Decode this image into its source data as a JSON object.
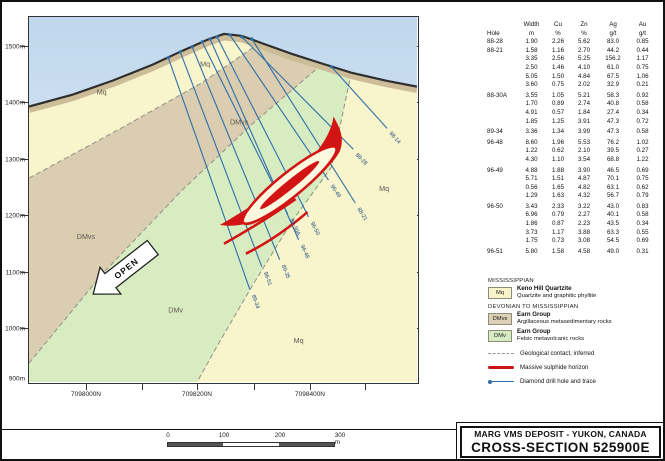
{
  "section": {
    "south": "SOUTH",
    "north": "NORTH",
    "elevations": [
      "1500m",
      "1400m",
      "1300m",
      "1200m",
      "1100m",
      "1000m",
      "900m"
    ],
    "northings": [
      "7098000N",
      "7098200N",
      "7098400N"
    ],
    "units": {
      "mq": "Mq",
      "dmvs": "DMvs",
      "dmv": "DMv"
    },
    "open_label": "OPEN",
    "drillholes": [
      "88-14",
      "88-28",
      "96-49",
      "88-21",
      "96-50",
      "88-30A",
      "96-48",
      "89-35",
      "96-51",
      "89-34"
    ]
  },
  "assay_table": {
    "headers": [
      "Hole",
      "Width",
      "Cu",
      "Zn",
      "Ag",
      "Au"
    ],
    "units": [
      "",
      "m",
      "%",
      "%",
      "g/t",
      "g/t"
    ],
    "rows": [
      [
        "88-28",
        "1.90",
        "2.26",
        "5.62",
        "83.0",
        "0.85"
      ],
      [
        "88-21",
        "1.58",
        "1.16",
        "2.70",
        "44.2",
        "0.44"
      ],
      [
        "",
        "3.35",
        "2.56",
        "5.25",
        "156.2",
        "1.17"
      ],
      [
        "",
        "2.50",
        "1.46",
        "4.10",
        "61.0",
        "0.75"
      ],
      [
        "",
        "5.05",
        "1.50",
        "4.84",
        "67.5",
        "1.06"
      ],
      [
        "",
        "3.60",
        "0.75",
        "2.02",
        "32.9",
        "0.21"
      ],
      [
        "88-30A",
        "3.55",
        "1.05",
        "5.21",
        "58.3",
        "0.92"
      ],
      [
        "",
        "1.70",
        "0.89",
        "2.74",
        "40.8",
        "0.58"
      ],
      [
        "",
        "4.91",
        "0.57",
        "1.84",
        "27.4",
        "0.34"
      ],
      [
        "",
        "1.85",
        "1.25",
        "3.91",
        "47.3",
        "0.72"
      ],
      [
        "89-34",
        "3.36",
        "1.34",
        "3.99",
        "47.3",
        "0.58"
      ],
      [
        "96-48",
        "8.60",
        "1.96",
        "5.53",
        "76.2",
        "1.02"
      ],
      [
        "",
        "1.22",
        "0.62",
        "2.10",
        "39.5",
        "0.27"
      ],
      [
        "",
        "4.30",
        "1.10",
        "3.54",
        "68.8",
        "1.22"
      ],
      [
        "96-49",
        "4.88",
        "1.88",
        "3.90",
        "46.5",
        "0.69"
      ],
      [
        "",
        "5.71",
        "1.51",
        "4.87",
        "70.1",
        "0.75"
      ],
      [
        "",
        "0.56",
        "1.65",
        "4.82",
        "63.1",
        "0.62"
      ],
      [
        "",
        "1.29",
        "1.63",
        "4.32",
        "56.7",
        "0.79"
      ],
      [
        "96-50",
        "3.43",
        "2.33",
        "3.22",
        "43.0",
        "0.83"
      ],
      [
        "",
        "6.96",
        "0.79",
        "2.27",
        "40.1",
        "0.58"
      ],
      [
        "",
        "1.86",
        "0.87",
        "2.23",
        "43.5",
        "0.34"
      ],
      [
        "",
        "3.73",
        "1.17",
        "3.88",
        "63.3",
        "0.55"
      ],
      [
        "",
        "1.75",
        "0.73",
        "3.08",
        "54.5",
        "0.69"
      ],
      [
        "96-51",
        "5.80",
        "1.58",
        "4.58",
        "49.0",
        "0.31"
      ]
    ]
  },
  "legend": {
    "era1": "MISSISSIPPIAN",
    "era2": "DEVONIAN TO MISSISSIPPIAN",
    "items": [
      {
        "code": "Mq",
        "color": "#f8f3c9",
        "title": "Keno Hill Quartzite",
        "desc": "Quartzite and graphitic phyllite"
      },
      {
        "code": "DMvs",
        "color": "#ddd0b4",
        "title": "Earn Group",
        "desc": "Argillaceous metasedimentary rocks"
      },
      {
        "code": "DMv",
        "color": "#d7ebc3",
        "title": "Earn Group",
        "desc": "Felsic metavolcanic rocks"
      }
    ],
    "lines": [
      {
        "type": "dashed",
        "label": "Geological contact, inferred"
      },
      {
        "type": "sulphide",
        "label": "Massive sulphide horizon"
      },
      {
        "type": "drill",
        "label": "Diamond drill hole and trace"
      }
    ]
  },
  "scalebar": {
    "labels": [
      "0",
      "100",
      "200",
      "300 m"
    ]
  },
  "title_block": {
    "line1": "MARG VMS DEPOSIT - YUKON, CANADA",
    "line2": "CROSS-SECTION 525900E"
  },
  "colors": {
    "mq": "#f8f4cb",
    "dmvs": "#dbcdb0",
    "dmv": "#d8ecc2",
    "sky_top": "#bfd7ec",
    "sky_bottom": "#edf6fc",
    "drill_trace": "#2e6ea9",
    "sulphide_red": "#d31414",
    "contact_dash": "#8f8f85"
  }
}
